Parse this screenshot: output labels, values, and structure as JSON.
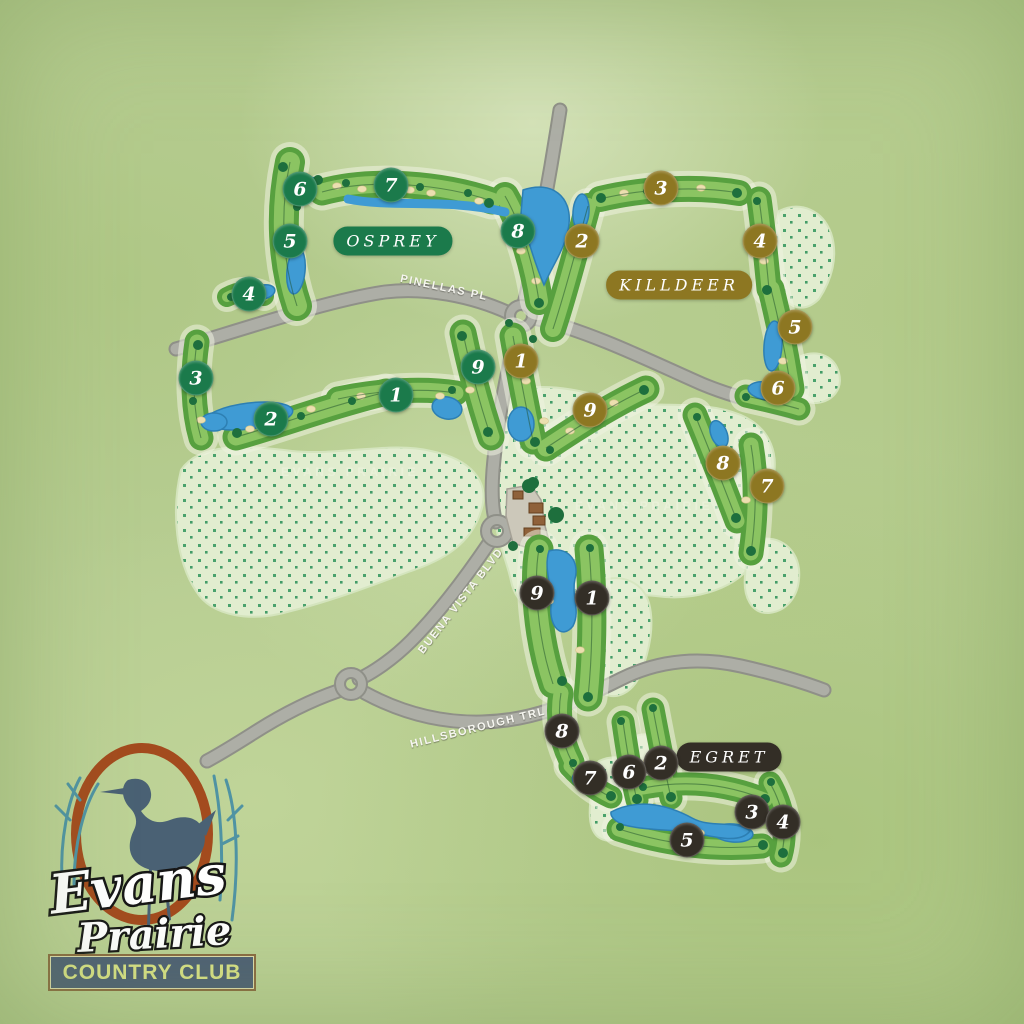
{
  "map_title": "Evans Prairie Country Club Course Map",
  "colors": {
    "background": "#b7cd92",
    "osprey": "#1b7a4b",
    "killdeer": "#8d7722",
    "egret": "#332e26",
    "water": "#3f9bd4",
    "fairway": "#5aa244",
    "road": "#adaea6",
    "logo_ring": "#a34b1e",
    "logo_heron": "#4a6174",
    "logo_plate": "#4e6075",
    "logo_plate_text": "#d9e287"
  },
  "courses": [
    {
      "id": "osprey",
      "label": "OSPREY",
      "color": "#1b7a4b",
      "badge": {
        "x": 393,
        "y": 241
      },
      "holes": [
        {
          "n": "1",
          "x": 396,
          "y": 395
        },
        {
          "n": "2",
          "x": 271,
          "y": 419
        },
        {
          "n": "3",
          "x": 196,
          "y": 378
        },
        {
          "n": "4",
          "x": 249,
          "y": 294
        },
        {
          "n": "5",
          "x": 290,
          "y": 241
        },
        {
          "n": "6",
          "x": 300,
          "y": 189
        },
        {
          "n": "7",
          "x": 391,
          "y": 185
        },
        {
          "n": "8",
          "x": 518,
          "y": 231
        },
        {
          "n": "9",
          "x": 478,
          "y": 367
        }
      ]
    },
    {
      "id": "killdeer",
      "label": "KILLDEER",
      "color": "#8d7722",
      "badge": {
        "x": 679,
        "y": 285
      },
      "holes": [
        {
          "n": "1",
          "x": 521,
          "y": 361
        },
        {
          "n": "2",
          "x": 582,
          "y": 241
        },
        {
          "n": "3",
          "x": 661,
          "y": 188
        },
        {
          "n": "4",
          "x": 760,
          "y": 241
        },
        {
          "n": "5",
          "x": 795,
          "y": 327
        },
        {
          "n": "6",
          "x": 778,
          "y": 388
        },
        {
          "n": "7",
          "x": 767,
          "y": 486
        },
        {
          "n": "8",
          "x": 723,
          "y": 463
        },
        {
          "n": "9",
          "x": 590,
          "y": 410
        }
      ]
    },
    {
      "id": "egret",
      "label": "EGRET",
      "color": "#332e26",
      "badge": {
        "x": 729,
        "y": 757
      },
      "holes": [
        {
          "n": "1",
          "x": 592,
          "y": 598
        },
        {
          "n": "2",
          "x": 661,
          "y": 763
        },
        {
          "n": "3",
          "x": 752,
          "y": 812
        },
        {
          "n": "4",
          "x": 783,
          "y": 822
        },
        {
          "n": "5",
          "x": 687,
          "y": 840
        },
        {
          "n": "6",
          "x": 629,
          "y": 772
        },
        {
          "n": "7",
          "x": 590,
          "y": 778
        },
        {
          "n": "8",
          "x": 562,
          "y": 731
        },
        {
          "n": "9",
          "x": 537,
          "y": 593
        }
      ]
    }
  ],
  "roads": [
    {
      "name": "PINELLAS PL",
      "x": 444,
      "y": 288,
      "rotate": 12
    },
    {
      "name": "BUENA VISTA BLVD",
      "x": 461,
      "y": 601,
      "rotate": -52
    },
    {
      "name": "HILLSBOROUGH TRL",
      "x": 478,
      "y": 728,
      "rotate": -14
    }
  ],
  "watermarks": [
    {
      "text": "EVANS PRAIRIE",
      "x": 350,
      "y": 472
    },
    {
      "text": "EVANS PRAIRIE",
      "x": 644,
      "y": 506
    }
  ],
  "logo": {
    "script_top": "Evans",
    "script_bottom": "Prairie",
    "tagline": "COUNTRY CLUB"
  }
}
